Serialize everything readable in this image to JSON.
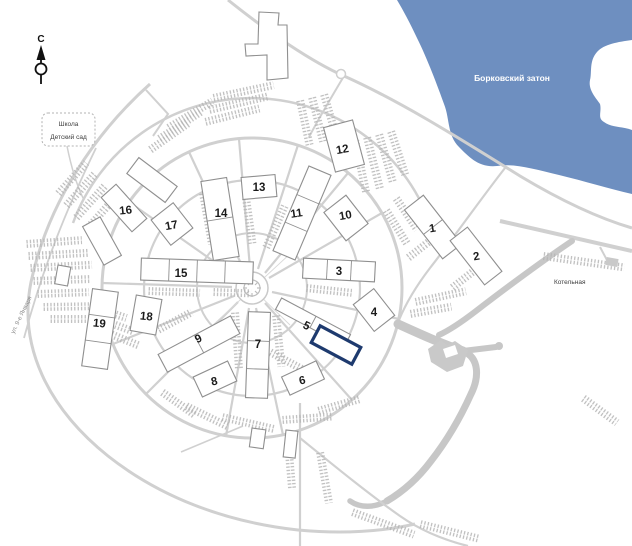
{
  "map": {
    "compass": {
      "north_label": "С"
    },
    "water": {
      "name": "Борковский затон"
    },
    "labels": {
      "school": "Школа",
      "kindergarten": "Детский сад",
      "boiler_house": "Котельная",
      "street": "ул. 9-е Января"
    },
    "buildings": [
      {
        "number": "1"
      },
      {
        "number": "2"
      },
      {
        "number": "3"
      },
      {
        "number": "4"
      },
      {
        "number": "5"
      },
      {
        "number": "6"
      },
      {
        "number": "7"
      },
      {
        "number": "8"
      },
      {
        "number": "9"
      },
      {
        "number": "10"
      },
      {
        "number": "11"
      },
      {
        "number": "12"
      },
      {
        "number": "13"
      },
      {
        "number": "14"
      },
      {
        "number": "15"
      },
      {
        "number": "16"
      },
      {
        "number": "17"
      },
      {
        "number": "18"
      },
      {
        "number": "19"
      }
    ],
    "colors": {
      "water": "#6E8FC0",
      "road": "#D0D0D0",
      "road_dark": "#C7C7C7",
      "hatch": "#B4B4B4",
      "building_outline": "#8F8F8F",
      "highlight": "#1E3A6E"
    }
  }
}
